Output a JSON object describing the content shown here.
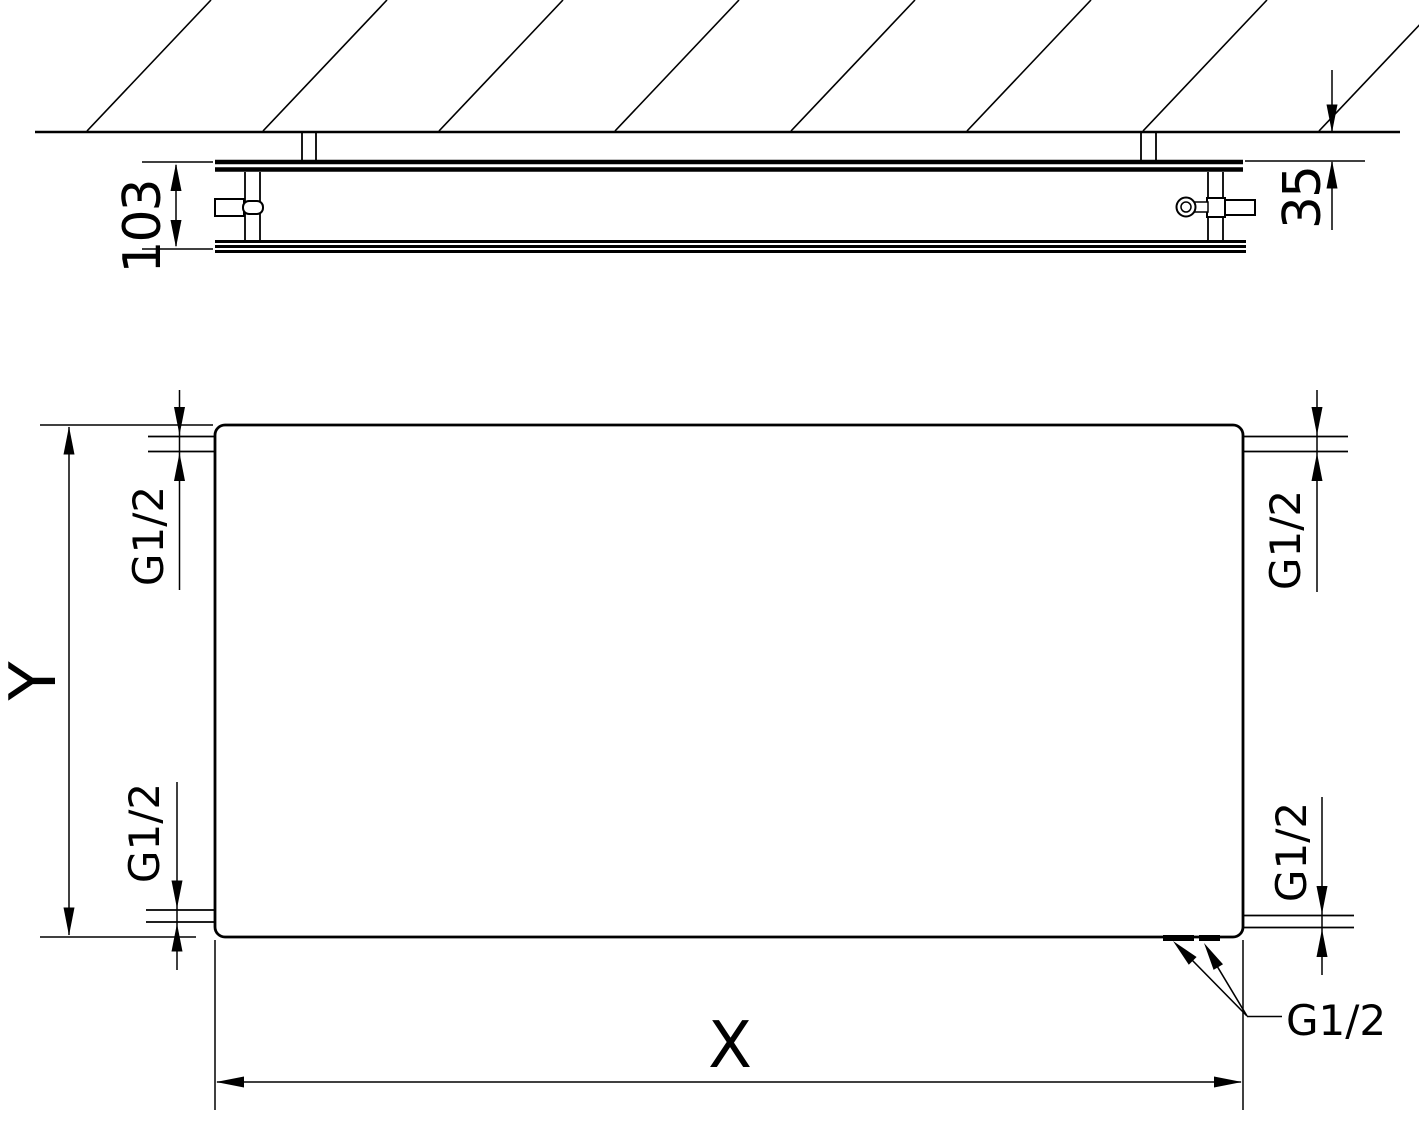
{
  "labels": {
    "depth": "103",
    "wall_distance": "35",
    "height_axis": "Y",
    "width_axis": "X",
    "thread_top_left": "G1/2",
    "thread_top_right": "G1/2",
    "thread_bottom_left": "G1/2",
    "thread_bottom_right": "G1/2",
    "thread_bottom_center": "G1/2"
  },
  "colors": {
    "line": "#000000",
    "background": "#ffffff"
  }
}
